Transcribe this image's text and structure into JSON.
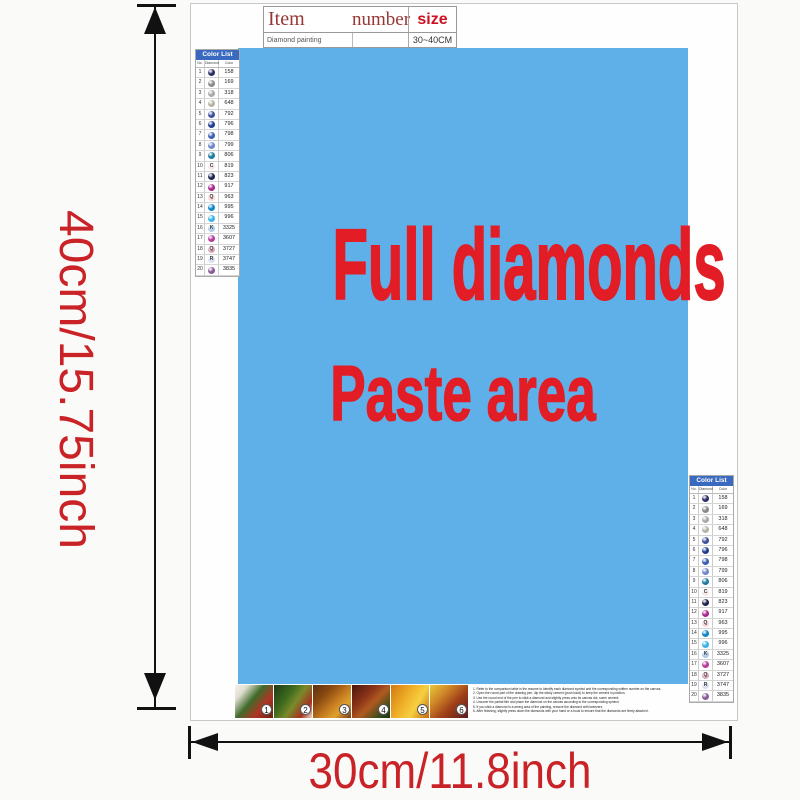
{
  "spec_table": {
    "col_item": "Item",
    "col_number": "number",
    "col_size": "size",
    "row_item": "Diamond painting",
    "row_number": "",
    "row_size": "30~40CM"
  },
  "paste_area": {
    "line1": "Full diamonds",
    "line2": "Paste area",
    "bg_color": "#5fb0e8",
    "text_color": "#e21d25"
  },
  "dimensions": {
    "height_label": "40cm/15.75inch",
    "width_label": "30cm/11.8inch",
    "label_color": "#c92227"
  },
  "color_list": {
    "title": "Color List",
    "col_no": "No.",
    "col_diamond": "Diamond",
    "col_color": "Color",
    "rows": [
      {
        "no": "1",
        "code": "158",
        "bg": "#2c3066",
        "symbol": "",
        "fg": "#ffffff"
      },
      {
        "no": "2",
        "code": "169",
        "bg": "#8a8a88",
        "symbol": "",
        "fg": "#ffffff"
      },
      {
        "no": "3",
        "code": "318",
        "bg": "#a9a9ab",
        "symbol": "",
        "fg": "#ffffff"
      },
      {
        "no": "4",
        "code": "648",
        "bg": "#b7b2a6",
        "symbol": "",
        "fg": "#ffffff"
      },
      {
        "no": "5",
        "code": "792",
        "bg": "#3c4f9d",
        "symbol": "",
        "fg": "#ffffff"
      },
      {
        "no": "6",
        "code": "796",
        "bg": "#1f3a8e",
        "symbol": "",
        "fg": "#ffffff"
      },
      {
        "no": "7",
        "code": "798",
        "bg": "#3a5cb2",
        "symbol": "",
        "fg": "#ffffff"
      },
      {
        "no": "8",
        "code": "799",
        "bg": "#6e86ca",
        "symbol": "",
        "fg": "#ffffff"
      },
      {
        "no": "9",
        "code": "806",
        "bg": "#1e7aa0",
        "symbol": "",
        "fg": "#ffffff"
      },
      {
        "no": "10",
        "code": "819",
        "bg": "#f9e6e8",
        "symbol": "C",
        "fg": "#333333"
      },
      {
        "no": "11",
        "code": "823",
        "bg": "#1b2452",
        "symbol": "",
        "fg": "#ffffff"
      },
      {
        "no": "12",
        "code": "917",
        "bg": "#a8268e",
        "symbol": "",
        "fg": "#ffffff"
      },
      {
        "no": "13",
        "code": "963",
        "bg": "#fad4d8",
        "symbol": "Q",
        "fg": "#333333"
      },
      {
        "no": "14",
        "code": "995",
        "bg": "#0e86c6",
        "symbol": "",
        "fg": "#ffffff"
      },
      {
        "no": "15",
        "code": "996",
        "bg": "#3ab2e8",
        "symbol": "",
        "fg": "#ffffff"
      },
      {
        "no": "16",
        "code": "3325",
        "bg": "#aecbe8",
        "symbol": "K",
        "fg": "#333333"
      },
      {
        "no": "17",
        "code": "3607",
        "bg": "#b83a9c",
        "symbol": "",
        "fg": "#ffffff"
      },
      {
        "no": "18",
        "code": "3727",
        "bg": "#d9a9bd",
        "symbol": "Q",
        "fg": "#553344"
      },
      {
        "no": "19",
        "code": "3747",
        "bg": "#dadef2",
        "symbol": "R",
        "fg": "#333333"
      },
      {
        "no": "20",
        "code": "3835",
        "bg": "#8a5a98",
        "symbol": "",
        "fg": "#ffffff"
      }
    ]
  },
  "steps": [
    {
      "n": "1",
      "art": "linear-gradient(130deg,#f5f2ea 0%,#e0ddd0 20%,#3f6b2a 45%,#b03425 70%,#6a1f12 100%)"
    },
    {
      "n": "2",
      "art": "linear-gradient(125deg,#1d3a14 0%,#3f6b1e 35%,#7a8a2a 55%,#a82f1f 80%,#e8ddc8 100%)"
    },
    {
      "n": "3",
      "art": "linear-gradient(135deg,#5a3010 0%,#8a4a10 30%,#c47a20 55%,#e0a030 75%,#7a3a0e 100%)"
    },
    {
      "n": "4",
      "art": "linear-gradient(135deg,#4a150c 0%,#8a3318 35%,#b05a20 55%,#2f4a1a 85%,#1e3010 100%)"
    },
    {
      "n": "5",
      "art": "linear-gradient(120deg,#d07a12 0%,#f0b028 40%,#f5d040 65%,#c46a10 100%)"
    },
    {
      "n": "6",
      "art": "linear-gradient(135deg,#e8c838 0%,#d08828 30%,#a04018 60%,#5a1a20 100%)"
    }
  ],
  "instructions": [
    "1. Refer to the comparison table in the resume to identify each diamond symbol and the corresponding written number on the canvas.",
    "2. Open the round part of the drawing pen, dip the sticky cement (push back) to keep the cement in position.",
    "3. Use the round end of the pen to stick a diamond and slightly press onto its canvas dot, some cement.",
    "4. Uncover the partial film and place the diamond on the canvas according to the corresponding symbol.",
    "5. If you stick a diamond in a wrong area of the painting, remove the diamond with tweezers.",
    "6. After finishing, slightly press down the diamonds with your hand or a book to ensure that the diamonds are firmly attached."
  ]
}
